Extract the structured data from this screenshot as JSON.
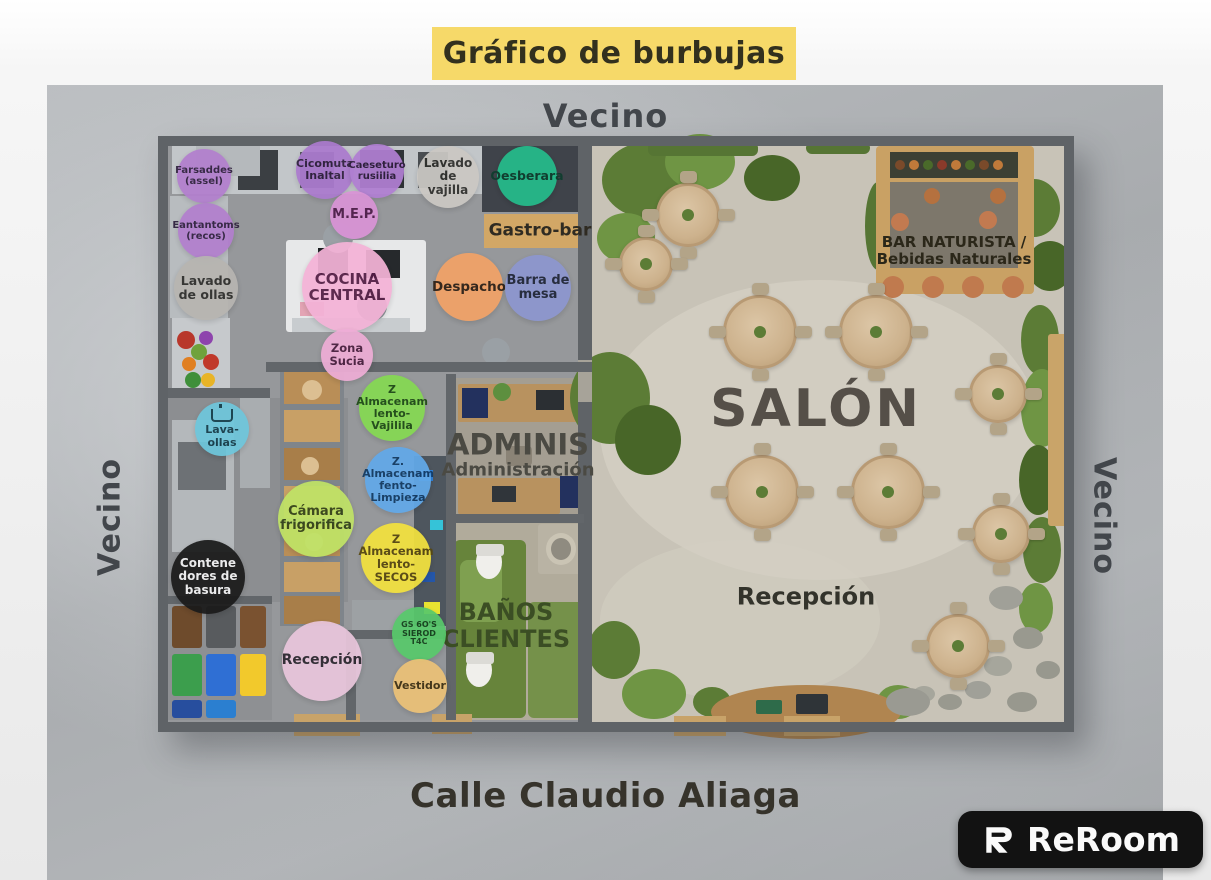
{
  "title": {
    "label": "Gráfico de burbujas"
  },
  "surroundings": {
    "top": "Vecino",
    "left": "Vecino",
    "right": "Vecino",
    "street": "Calle Claudio Aliaga"
  },
  "brand": {
    "name": "ReRoom",
    "icon": "reroom-r-icon"
  },
  "colors": {
    "title_bg": "#f6d969",
    "title_text": "#32301e",
    "wall": "#5f6367",
    "kitchen_floor": "#96989b",
    "salon_floor": "#c8c3b7",
    "neighbor_text": "#42464b",
    "street_text": "#36332b",
    "logo_bg": "#121212"
  },
  "bubbles": [
    {
      "id": "farsaddes",
      "lines": [
        "Farsaddes",
        "(assel)"
      ],
      "bg": "#b27fce",
      "fg": "#2e1f3d"
    },
    {
      "id": "eantantoms",
      "lines": [
        "Eantantoms",
        "(recos)"
      ],
      "bg": "#b27fce",
      "fg": "#2e1f3d"
    },
    {
      "id": "cicomuta",
      "lines": [
        "Cicomuta",
        "Inaltal"
      ],
      "bg": "#ab7ace",
      "fg": "#2e1f3d"
    },
    {
      "id": "caeseturo",
      "lines": [
        "Caeseturo",
        "rusiilia"
      ],
      "bg": "#b07fd2",
      "fg": "#2e1f3d"
    },
    {
      "id": "lavado-vajilla",
      "lines": [
        "Lavado de",
        "vajilla"
      ],
      "bg": "#cbc8c3",
      "fg": "#2f2f2c"
    },
    {
      "id": "oesberara",
      "lines": [
        "Oesberara"
      ],
      "bg": "#25bc8b",
      "fg": "#0e3d2e"
    },
    {
      "id": "mep",
      "lines": [
        "M.E.P."
      ],
      "bg": "#d993d6",
      "fg": "#4e1d4a"
    },
    {
      "id": "cocina-central",
      "lines": [
        "COCINA",
        "CENTRAL"
      ],
      "bg": "#f4b3d7",
      "fg": "#531c44"
    },
    {
      "id": "despacho",
      "lines": [
        "Despacho"
      ],
      "bg": "#f2a267",
      "fg": "#2e2015"
    },
    {
      "id": "barra-mesa",
      "lines": [
        "Barra de",
        "mesa"
      ],
      "bg": "#8d96cf",
      "fg": "#1f2538"
    },
    {
      "id": "zona-sucia",
      "lines": [
        "Zona",
        "Sucia"
      ],
      "bg": "#eeadd6",
      "fg": "#4b2040"
    },
    {
      "id": "lavado-ollas",
      "lines": [
        "Lavado",
        "de ollas"
      ],
      "bg": "#b7b5b1",
      "fg": "#2e2e2b"
    },
    {
      "id": "lava-ollas",
      "lines": [
        "Lava-ollas"
      ],
      "icon": "sink-icon",
      "bg": "#6ec6dc",
      "fg": "#143c49"
    },
    {
      "id": "z-vajilla",
      "lines": [
        "Z",
        "Almacenam",
        "lento-",
        "Vajilila"
      ],
      "bg": "#85d952",
      "fg": "#1d4a14"
    },
    {
      "id": "z-limpieza",
      "lines": [
        "Z.",
        "Almacenam",
        "fento-",
        "Limpieza"
      ],
      "bg": "#62a9e9",
      "fg": "#113a63"
    },
    {
      "id": "z-secos",
      "lines": [
        "Z",
        "Almacenam",
        "lento-",
        "SECOS"
      ],
      "bg": "#f3e23e",
      "fg": "#57470f"
    },
    {
      "id": "camara",
      "lines": [
        "Cámara",
        "frigorifica"
      ],
      "bg": "#c0e366",
      "fg": "#33431a"
    },
    {
      "id": "contenedores",
      "lines": [
        "Contene",
        "dores de",
        "basura"
      ],
      "bg": "#1a1a1a",
      "fg": "#f2f2f2"
    },
    {
      "id": "recepcion",
      "lines": [
        "Recepción"
      ],
      "bg": "#e9c6dc",
      "fg": "#2d2830"
    },
    {
      "id": "gs",
      "lines": [
        "GS 6O'S",
        "SIEROD",
        "T4C"
      ],
      "bg": "#58c96b",
      "fg": "#14421c"
    },
    {
      "id": "vestidor",
      "lines": [
        "Vestidor"
      ],
      "bg": "#ecc277",
      "fg": "#3f3012"
    }
  ],
  "zones": [
    {
      "id": "gastro-bar",
      "lines": [
        "Gastro-bar"
      ],
      "color": "#2f2b22"
    },
    {
      "id": "adminis",
      "lines": [
        "ADMINIS",
        "Administración"
      ],
      "color": "#4b4a43"
    },
    {
      "id": "banos-clientes",
      "lines": [
        "BAÑOS",
        "CLIENTES"
      ],
      "color": "#3b4e24"
    },
    {
      "id": "salon",
      "lines": [
        "SALÓN"
      ],
      "color": "#554f48"
    },
    {
      "id": "recepcion-salon",
      "lines": [
        "Recepción"
      ],
      "color": "#33332b"
    },
    {
      "id": "bar-naturista",
      "lines": [
        "BAR NATURISTA /",
        "Bebidas Naturales"
      ],
      "color": "#2b2719"
    }
  ]
}
